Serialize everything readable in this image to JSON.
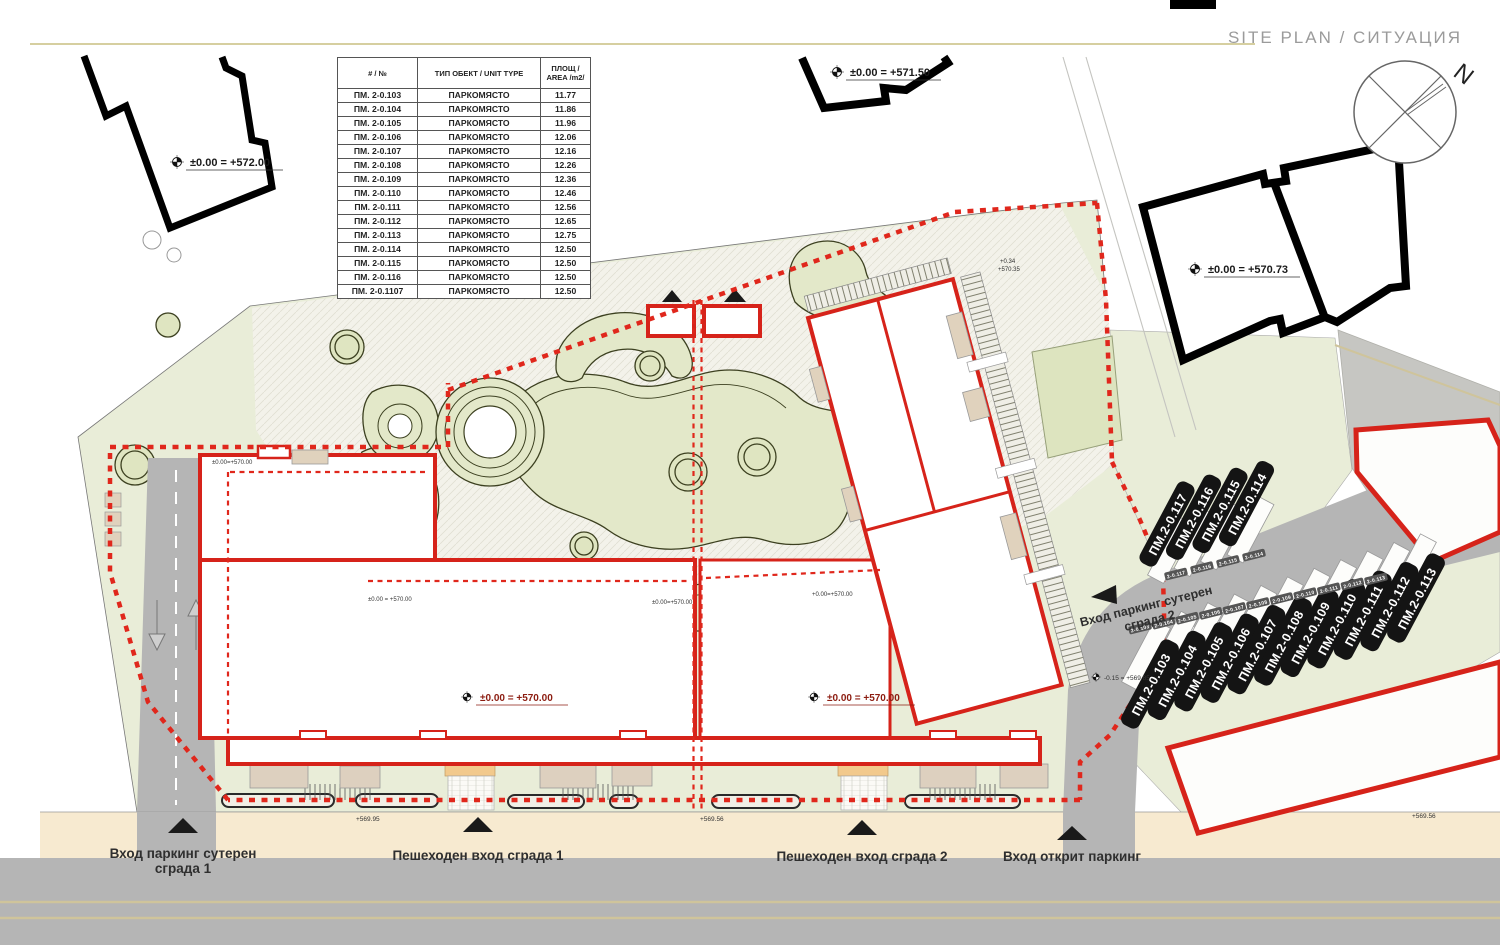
{
  "title": "SITE PLAN / СИТУАЦИЯ",
  "compass": {
    "north": "N"
  },
  "table": {
    "headers": [
      "# / №",
      "ТИП ОБЕКТ / UNIT TYPE",
      "ПЛОЩ / AREA /m2/"
    ],
    "rows": [
      [
        "ПМ. 2-0.103",
        "ПАРКОМЯСТО",
        "11.77"
      ],
      [
        "ПМ. 2-0.104",
        "ПАРКОМЯСТО",
        "11.86"
      ],
      [
        "ПМ. 2-0.105",
        "ПАРКОМЯСТО",
        "11.96"
      ],
      [
        "ПМ. 2-0.106",
        "ПАРКОМЯСТО",
        "12.06"
      ],
      [
        "ПМ. 2-0.107",
        "ПАРКОМЯСТО",
        "12.16"
      ],
      [
        "ПМ. 2-0.108",
        "ПАРКОМЯСТО",
        "12.26"
      ],
      [
        "ПМ. 2-0.109",
        "ПАРКОМЯСТО",
        "12.36"
      ],
      [
        "ПМ. 2-0.110",
        "ПАРКОМЯСТО",
        "12.46"
      ],
      [
        "ПМ. 2-0.111",
        "ПАРКОМЯСТО",
        "12.56"
      ],
      [
        "ПМ. 2-0.112",
        "ПАРКОМЯСТО",
        "12.65"
      ],
      [
        "ПМ. 2-0.113",
        "ПАРКОМЯСТО",
        "12.75"
      ],
      [
        "ПМ. 2-0.114",
        "ПАРКОМЯСТО",
        "12.50"
      ],
      [
        "ПМ. 2-0.115",
        "ПАРКОМЯСТО",
        "12.50"
      ],
      [
        "ПМ. 2-0.116",
        "ПАРКОМЯСТО",
        "12.50"
      ],
      [
        "ПМ. 2-0.1107",
        "ПАРКОМЯСТО",
        "12.50"
      ]
    ]
  },
  "elevations": {
    "main_572": "±0.00 = +572.00",
    "main_5715": "±0.00 = +571.50",
    "main_57073": "±0.00 = +570.73",
    "court1": "±0.00 = +570.00",
    "court2": "±0.00 = +570.00",
    "b1_corner": "±0.00=+570.00",
    "b1_south": "±0.00 = +570.00",
    "b1_mid": "±0.00=+570.00",
    "b2_west": "+0.00=+570.00",
    "p034": "+0.34",
    "p57035": "+570.35",
    "open_lot": "-0.15 = +569.85",
    "sw1": "+569.95",
    "sw2": "+569.56",
    "sw3": "+569.56"
  },
  "entrances": {
    "garage1_line1": "Вход паркинг сутерен",
    "garage1_line2": "сграда 1",
    "ped1": "Пешеходен вход сграда 1",
    "ped2": "Пешеходен вход сграда 2",
    "open_parking": "Вход открит паркинг",
    "garage2_line1": "Вход паркинг сутерен",
    "garage2_line2": "сграда 2"
  },
  "parking": {
    "top_labels": [
      "ПМ.2-0.117",
      "ПМ.2-0.116",
      "ПМ.2-0.115",
      "ПМ.2-0.114"
    ],
    "bottom_labels": [
      "ПМ.2-0.103",
      "ПМ.2-0.104",
      "ПМ.2-0.105",
      "ПМ.2-0.106",
      "ПМ.2-0.107",
      "ПМ.2-0.108",
      "ПМ.2-0.109",
      "ПМ.2-0.110",
      "ПМ.2-0.111",
      "ПМ.2-0.112",
      "ПМ.2-0.113"
    ],
    "stall_tags_top": [
      "2-0.117",
      "2-0.116",
      "2-0.115",
      "2-0.114"
    ],
    "stall_tags_bottom": [
      "2-0.103",
      "2-0.104",
      "2-0.105",
      "2-0.106",
      "2-0.107",
      "2-0.108",
      "2-0.109",
      "2-0.110",
      "2-0.111",
      "2-0.112",
      "2-0.113"
    ]
  },
  "colors": {
    "accent_red": "#d6231a",
    "dashed_red": "#e0271c",
    "parcel_green": "#e9edd8",
    "road_gray": "#b5b5b5",
    "sidewalk": "#f7ead0",
    "rule_olive": "#d6cfa0",
    "pill_black": "#141414"
  }
}
